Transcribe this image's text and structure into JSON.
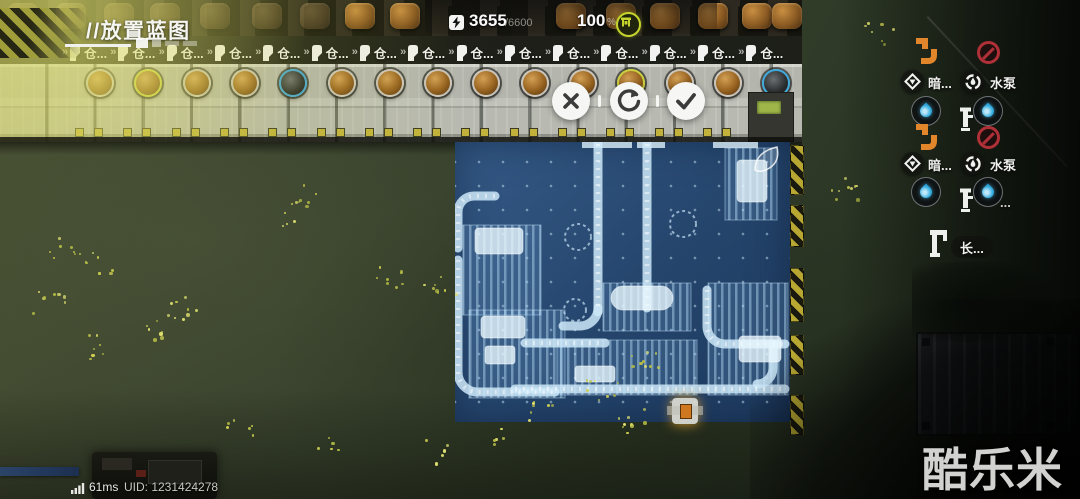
{
  "title": {
    "text": "//放置蓝图"
  },
  "hud": {
    "energy_value": "3655",
    "energy_max": "/6600",
    "percent_value": "100",
    "percent_unit": "%"
  },
  "warehouses": {
    "label": "仓...",
    "count": 15,
    "rings": [
      "default",
      "yellow",
      "default",
      "default",
      "blue",
      "default",
      "default",
      "default",
      "default",
      "default",
      "default",
      "yellow",
      "default",
      "default",
      "blue"
    ],
    "dark_slots": [
      4,
      14
    ]
  },
  "actions": {
    "cancel": "cancel-blueprint",
    "rotate": "rotate-blueprint",
    "confirm": "confirm-blueprint"
  },
  "right_panel": {
    "groups": [
      {
        "a": "暗...",
        "b": "水泵"
      },
      {
        "a": "暗...",
        "b": "水泵"
      }
    ],
    "ellipsis": "...",
    "pipe": "长..."
  },
  "status": {
    "ping": "61ms",
    "uid": "UID: 1231424278"
  },
  "watermark": "酷乐米",
  "colors": {
    "accent_yellow": "#c6d42e",
    "blueprint_blue": "#2a4a74",
    "drop_blue": "#35aee0",
    "warn_orange": "#e2862c",
    "forbid_red": "#b03038",
    "ring_yellow": "#c9d03c",
    "ring_blue": "#41a8da"
  }
}
